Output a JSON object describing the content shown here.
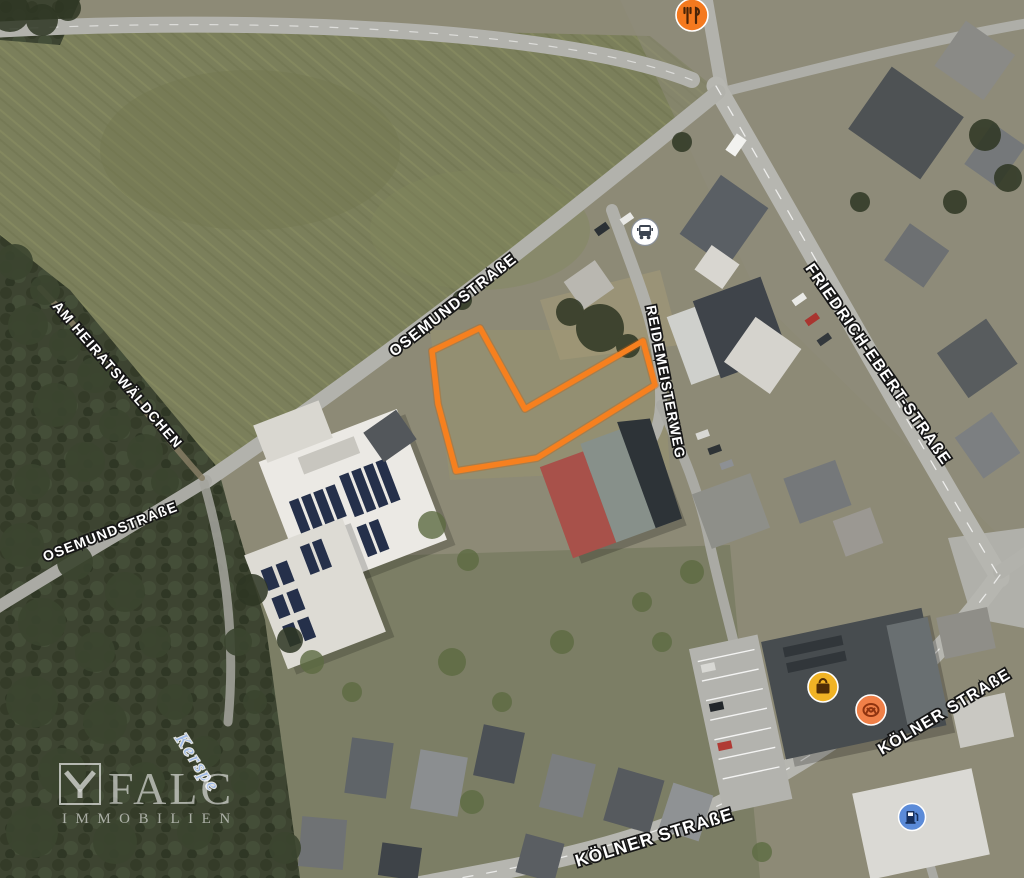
{
  "map": {
    "street_labels": {
      "osemundstrasse_upper": "OSEMUNDSTRAßE",
      "osemundstrasse_lower": "OSEMUNDSTRAßE",
      "am_heiratswaeldchen": "AM HEIRATSWÄLDCHEN",
      "reidemeisterweg": "REIDEMEISTERWEG",
      "friedrich_ebert_strasse": "FRIEDRICH-EBERT-STRAßE",
      "koelner_strasse_right": "KÖLNER STRAßE",
      "koelner_strasse_bottom": "KÖLNER STRAßE"
    },
    "water_labels": {
      "kerspe": "Kerspe"
    },
    "pois": {
      "restaurant": {
        "type": "restaurant",
        "color": "#f4791f",
        "glyph_color": "#4a2408"
      },
      "bus_stop": {
        "type": "bus-stop",
        "color": "#ffffff",
        "glyph_color": "#3c4450"
      },
      "shopping": {
        "type": "shopping",
        "color": "#f0b325",
        "glyph_color": "#4f2d06"
      },
      "bakery": {
        "type": "bakery",
        "color": "#f08048",
        "glyph_color": "#8f3410"
      },
      "fuel": {
        "type": "fuel-station",
        "color": "#5b8bd8",
        "glyph_color": "#17305c"
      }
    },
    "parcel_outline_color": "#f6801f",
    "watermark": {
      "brand": "FALC",
      "subtitle": "IMMOBILIEN"
    }
  }
}
